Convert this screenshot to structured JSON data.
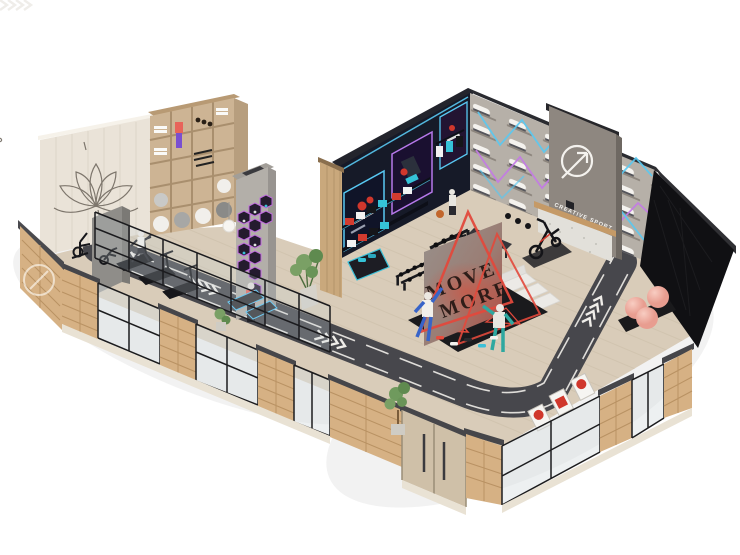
{
  "meta": {
    "description": "Isometric 3D visualization of an L-shaped Creative Sport retail store interior",
    "background": "#ffffff"
  },
  "signage": {
    "brand_name": "CREATIVE SPORT",
    "move_more_line1": "MOVE",
    "move_more_line2": "MORE"
  },
  "palette": {
    "floor_wood": "#d9ccb9",
    "plank_line": "#cbbda8",
    "track": "#47474c",
    "track_marking": "#efede9",
    "brick": "#d6b184",
    "brick_joint": "#b99263",
    "apparel_wall": "#161a28",
    "sneaker_wall": "#b6b0a8",
    "neon_blue": "#59c9f2",
    "neon_purple": "#c47ae6",
    "accent_red": "#e2493c",
    "gym_ball_pink": "#efb0a4",
    "sign_panel": "#8e8780",
    "wood_shelving": "#cdb494",
    "media_wall_black": "#101013",
    "lotus_line": "#6b635a"
  },
  "elements": [
    "running-track",
    "track-chevrons",
    "lotus-wall-art",
    "equipment-shelving",
    "hex-display-column",
    "apparel-wall-posters",
    "sneaker-wall",
    "brand-sign",
    "reception-desk",
    "media-wall",
    "move-more-display",
    "mannequins",
    "cardio-zone-treadmills",
    "storefront-glass",
    "entrance-doors",
    "pink-gym-balls",
    "dumbbell-racks",
    "punching-bags",
    "bench-sofa",
    "spin-bike",
    "potted-plants"
  ]
}
